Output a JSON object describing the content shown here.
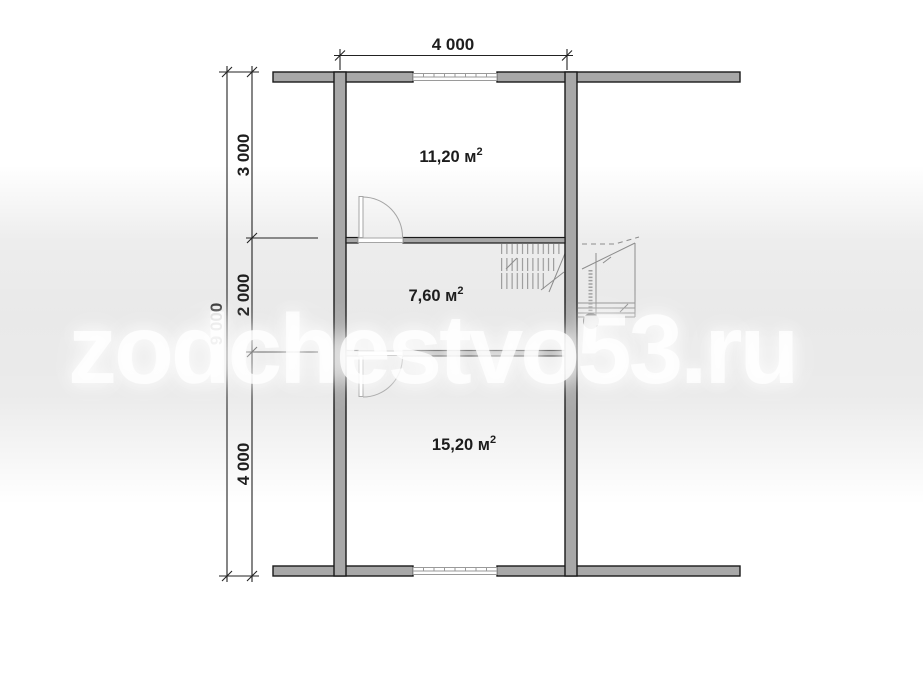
{
  "watermark": {
    "text": "zodchestvo53.ru"
  },
  "plan": {
    "type": "floor-plan",
    "dimensions": {
      "width_top": "4 000",
      "height_total": "9 000",
      "height_segments": [
        "3 000",
        "2 000",
        "4 000"
      ]
    },
    "rooms": [
      {
        "id": "room-top",
        "area_label": "11,20 м",
        "sup": "2"
      },
      {
        "id": "room-middle",
        "area_label": "7,60 м",
        "sup": "2"
      },
      {
        "id": "room-bottom",
        "area_label": "15,20 м",
        "sup": "2"
      }
    ]
  },
  "colors": {
    "wall_fill": "#a8a8a8",
    "wall_outline": "#1a1a1a",
    "dimension_lines": "#222222",
    "thin_detail": "#9a9a9a",
    "stair_detail": "#8d8d8d",
    "landing_dot": "#6f6f6f",
    "band": "#e6e6e6",
    "watermark": "#ffffff"
  }
}
